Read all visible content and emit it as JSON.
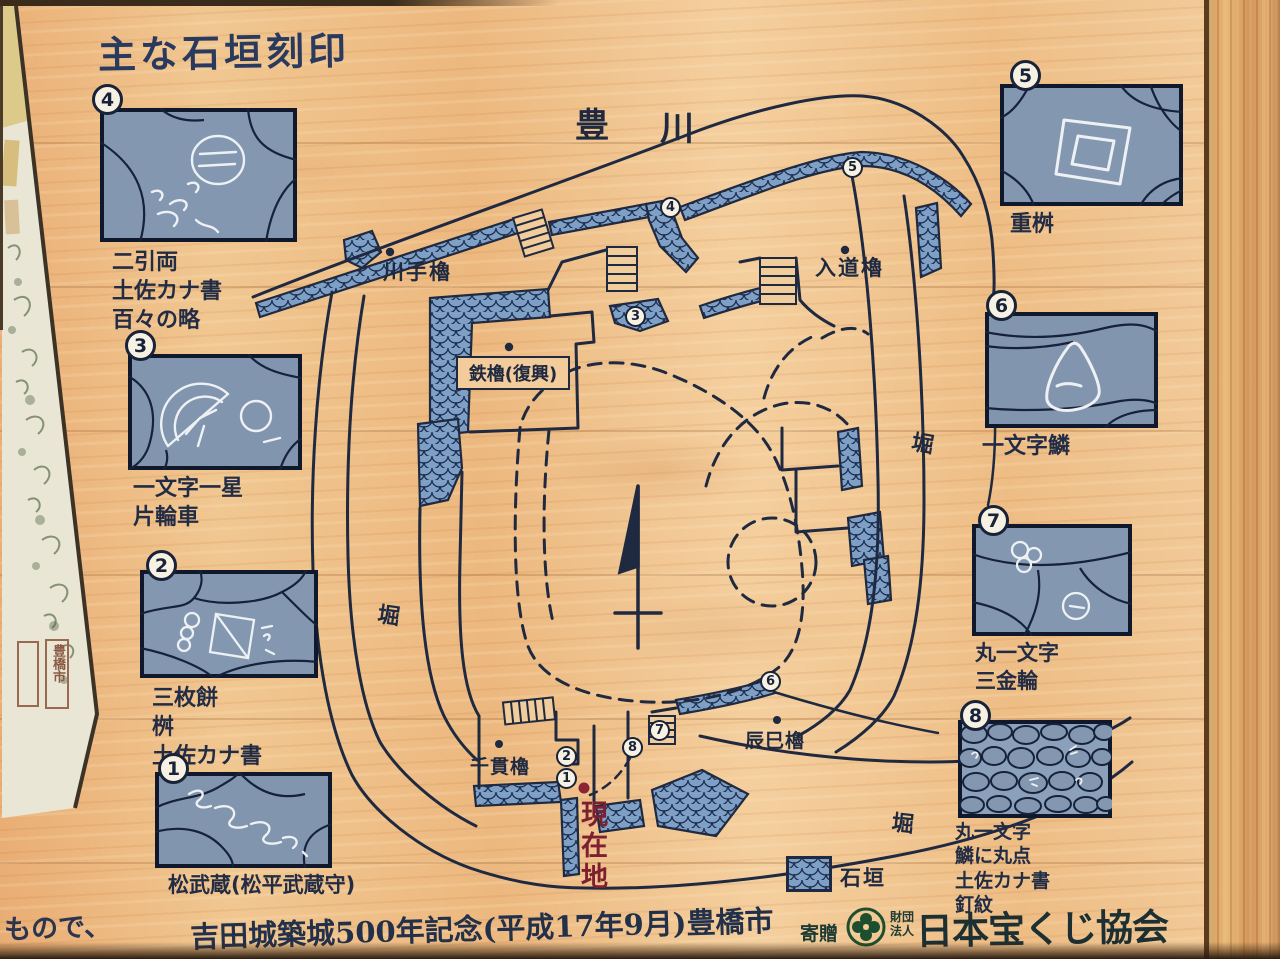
{
  "title": "主な石垣刻印",
  "panels": [
    {
      "num": "1",
      "labels": [
        "松武蔵(松平武蔵守)"
      ]
    },
    {
      "num": "2",
      "labels": [
        "三枚餅",
        "桝",
        "土佐カナ書"
      ]
    },
    {
      "num": "3",
      "labels": [
        "一文字一星",
        "片輪車"
      ]
    },
    {
      "num": "4",
      "labels": [
        "二引両",
        "土佐カナ書",
        "百々の略"
      ]
    },
    {
      "num": "5",
      "labels": [
        "重桝"
      ]
    },
    {
      "num": "6",
      "labels": [
        "一文字鱗"
      ]
    },
    {
      "num": "7",
      "labels": [
        "丸一文字",
        "三金輪"
      ]
    },
    {
      "num": "8",
      "labels": [
        "丸一文字",
        "鱗に丸点",
        "土佐カナ書",
        "釘紋"
      ]
    }
  ],
  "map": {
    "river_chars": [
      "豊",
      "川"
    ],
    "towers": {
      "kawate": "川手櫓",
      "nyudo": "入道櫓",
      "kurogane": "鉄櫓(復興)",
      "sengan": "千貫櫓",
      "tatsumi": "辰巳櫓"
    },
    "moat_label": "堀",
    "current_location": "現在地",
    "legend_label": "石垣",
    "markers": [
      "1",
      "2",
      "3",
      "4",
      "5",
      "6",
      "7",
      "8"
    ]
  },
  "footer": {
    "memorial": "吉田城築城500年記念(平成17年9月)豊橋市",
    "donation": "寄贈",
    "foundation_line1": "財団",
    "foundation_line2": "法人",
    "association": "日本宝くじ協会"
  },
  "adjacent": {
    "fragment_text": "もので、",
    "seal_text": "豊橋市"
  },
  "colors": {
    "ink": "#1f2940",
    "stone_blue": "#8397b1",
    "scale_blue": "#7fa0c6",
    "red_marker": "#8c2435",
    "wood": "#efc08d"
  }
}
